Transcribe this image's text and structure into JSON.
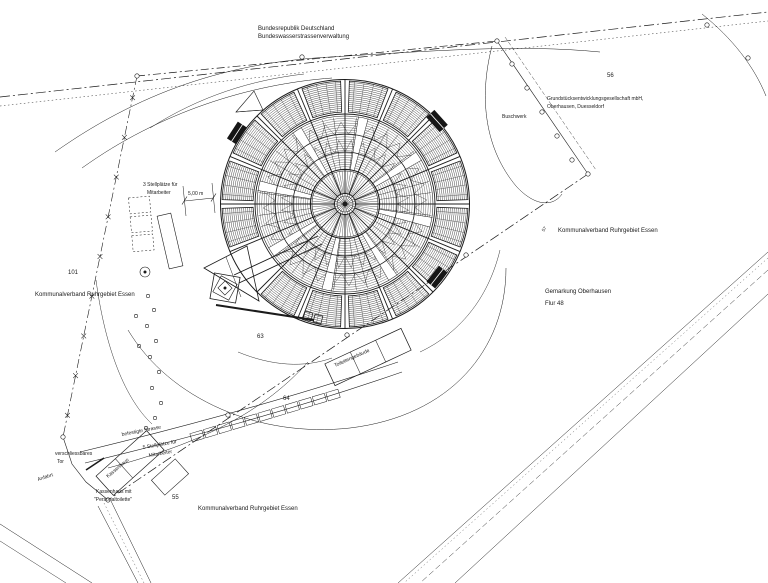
{
  "colors": {
    "background": "#ffffff",
    "line": "#1b1b1b"
  },
  "labels": {
    "federal1": "Bundesrepublik Deutschland",
    "federal2": "Bundeswasserstrassenverwaltung",
    "parcel_56": "56",
    "developer1": "Grundstücksentwicklungsgesellschaft mbH,",
    "developer2": "Oberhausen, Duesseldorf",
    "shrubs": "Buschwerk",
    "owner_right": "Kommunalverband Ruhrgebiet Essen",
    "district1": "Gemarkung Oberhausen",
    "district2": "Flur 48",
    "marker57": "57",
    "parcel_101": "101",
    "owner_left": "Kommunalverband Ruhrgebiet Essen",
    "parking3a": "3 Stellplätze für",
    "parking3b": "Mitarbeiter",
    "dim5": "5,00 m",
    "parcel_63": "63",
    "toilet": "Toilettengebäude",
    "parcel_64": "64",
    "road": "befestigte Strasse",
    "parking5a": "5 Stellplätze für",
    "parking5b": "Mitarbeiter",
    "gate1": "verschliessbares",
    "gate2": "Tor",
    "approach": "Anfahrt",
    "ticket_on": "Kassenhaus",
    "ticket1": "Kassenhaus mit",
    "ticket2": "\"Personaltoilette\"",
    "parcel_55": "55",
    "owner_bottom": "Kommunalverband Ruhrgebiet Essen"
  }
}
